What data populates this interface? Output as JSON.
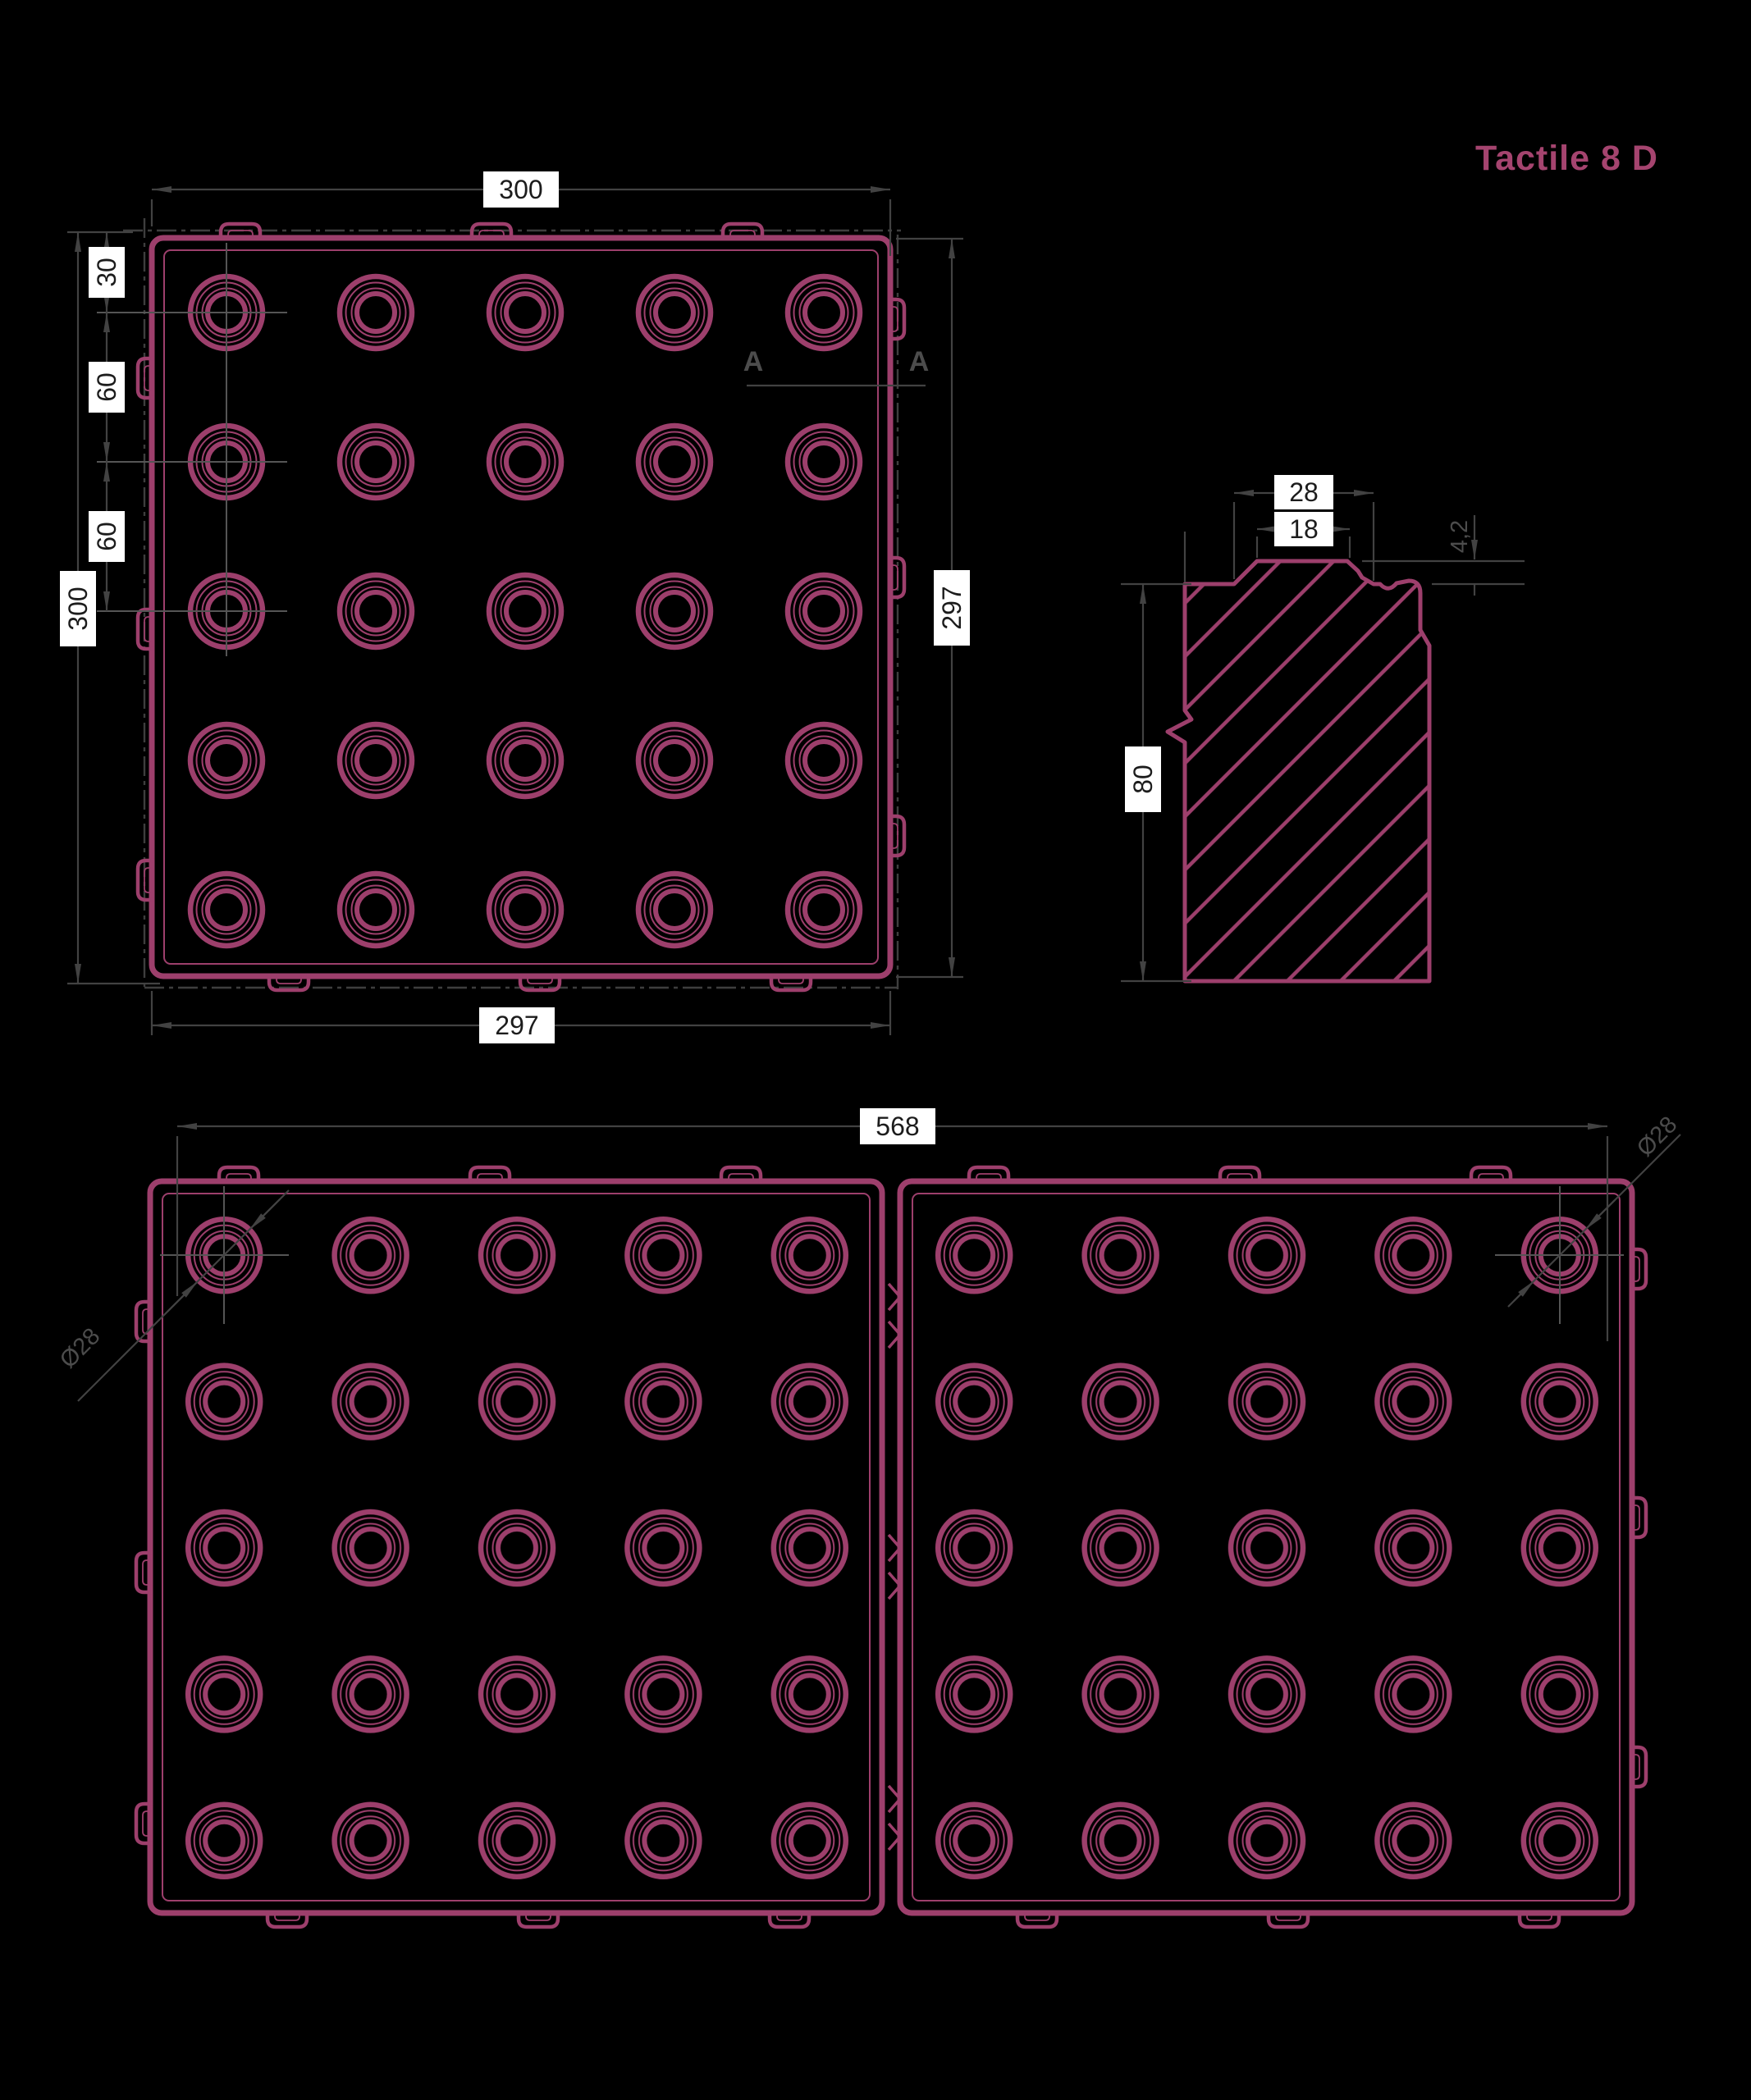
{
  "title": "Tactile 8 D",
  "colors": {
    "background": "#000000",
    "drawing_magenta": "#9d3f6c",
    "title_magenta": "#a5446f",
    "dimension_grey": "#424242",
    "label_box_bg": "#ffffff",
    "label_text": "#1c1c1c"
  },
  "plan_view": {
    "dim_overall_width": "300",
    "dim_overall_height": "300",
    "dim_edge_to_row1": "30",
    "dim_row1_to_row2": "60",
    "dim_row2_to_row3": "60",
    "dim_body_height": "297",
    "dim_body_width": "297",
    "section_label_left": "A",
    "section_label_right": "A"
  },
  "section_view": {
    "dim_dome_base_width": "28",
    "dim_dome_top_width": "18",
    "dim_dome_height": "4,2",
    "dim_tile_thickness": "80"
  },
  "pair_view": {
    "dim_span": "568",
    "dim_dome_diameter_left": "Ø28",
    "dim_dome_diameter_right": "Ø28"
  }
}
